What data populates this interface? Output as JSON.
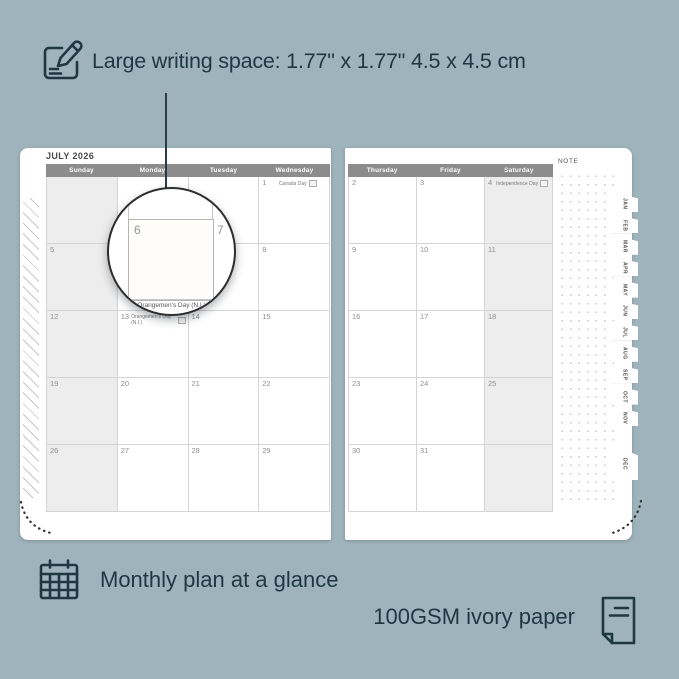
{
  "colors": {
    "background": "#9FB3BC",
    "ink": "#1E3741",
    "page": "#FFFFFF",
    "header_bar": "#8C8C8C",
    "weekend_shade": "#EDEDED",
    "grid_line": "#D4D4D4",
    "date_number": "#8F8F8F"
  },
  "callouts": {
    "writing_space": "Large writing space: 1.77\" x 1.77\" 4.5 x 4.5 cm",
    "monthly_plan": "Monthly plan at a glance",
    "paper": "100GSM ivory paper"
  },
  "planner": {
    "month_title": "JULY 2026",
    "note_label": "NOTE",
    "left_page": {
      "day_headers": [
        "Sunday",
        "Monday",
        "Tuesday",
        "Wednesday"
      ],
      "weekend_col": 0,
      "rows": [
        [
          {
            "day": ""
          },
          {
            "day": ""
          },
          {
            "day": ""
          },
          {
            "day": "1",
            "event": "Canada Day"
          }
        ],
        [
          {
            "day": "5"
          },
          {
            "day": "6"
          },
          {
            "day": "7"
          },
          {
            "day": "8"
          }
        ],
        [
          {
            "day": "12"
          },
          {
            "day": "13",
            "event": "Orangemen's Day (N.I.)"
          },
          {
            "day": "14"
          },
          {
            "day": "15"
          }
        ],
        [
          {
            "day": "19"
          },
          {
            "day": "20"
          },
          {
            "day": "21"
          },
          {
            "day": "22"
          }
        ],
        [
          {
            "day": "26"
          },
          {
            "day": "27"
          },
          {
            "day": "28"
          },
          {
            "day": "29"
          }
        ]
      ]
    },
    "right_page": {
      "day_headers": [
        "Thursday",
        "Friday",
        "Saturday"
      ],
      "weekend_col": 2,
      "rows": [
        [
          {
            "day": "2"
          },
          {
            "day": "3"
          },
          {
            "day": "4",
            "event": "Independence Day"
          }
        ],
        [
          {
            "day": "9"
          },
          {
            "day": "10"
          },
          {
            "day": "11"
          }
        ],
        [
          {
            "day": "16"
          },
          {
            "day": "17"
          },
          {
            "day": "18"
          }
        ],
        [
          {
            "day": "23"
          },
          {
            "day": "24"
          },
          {
            "day": "25"
          }
        ],
        [
          {
            "day": "30"
          },
          {
            "day": "31"
          },
          {
            "day": ""
          }
        ]
      ]
    },
    "month_tabs": [
      "JAN",
      "FEB",
      "MAR",
      "APR",
      "MAY",
      "JUN",
      "JUL",
      "AUG",
      "SEP",
      "OCT",
      "NOV",
      "DEC"
    ],
    "magnifier": {
      "left_day": "6",
      "right_day": "7",
      "clipped_day": "13",
      "event": "Orangemen's Day (N.I.)"
    }
  }
}
